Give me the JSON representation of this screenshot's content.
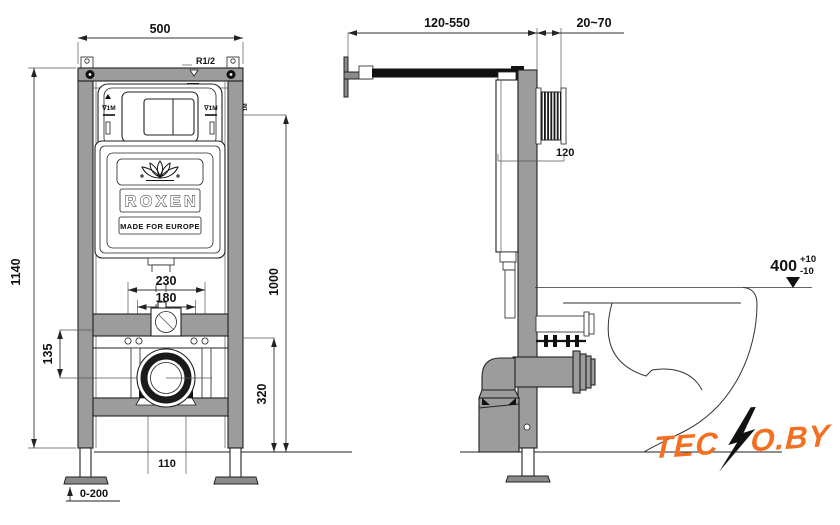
{
  "drawing": {
    "brand": {
      "name": "ROXEN",
      "tagline": "MADE FOR EUROPE"
    },
    "front_view": {
      "dim_width_top": "500",
      "dim_height_total": "1140",
      "dim_holes_outer": "230",
      "dim_holes_inner": "180",
      "dim_drain_offset": "135",
      "dim_level_height": "1000",
      "dim_drain_height": "320",
      "dim_bottom_width": "110",
      "dim_feet_range": "0-200",
      "inlet_label": "R1/2",
      "level_mark_left": "∇1M",
      "level_mark_right": "∇1M",
      "level_mark_small": "1M"
    },
    "side_view": {
      "dim_bracket_range": "120-550",
      "dim_wall_gap": "20~70",
      "dim_frame_depth": "120",
      "dim_seat_height": "400",
      "tol_plus": "+10",
      "tol_minus": "-10"
    },
    "watermark": {
      "part1": "TEC",
      "part2": "O.BY"
    },
    "colors": {
      "frame_gray": "#9c9c9c",
      "logo_orange": "#f36f21",
      "line_dark": "#222222"
    }
  }
}
